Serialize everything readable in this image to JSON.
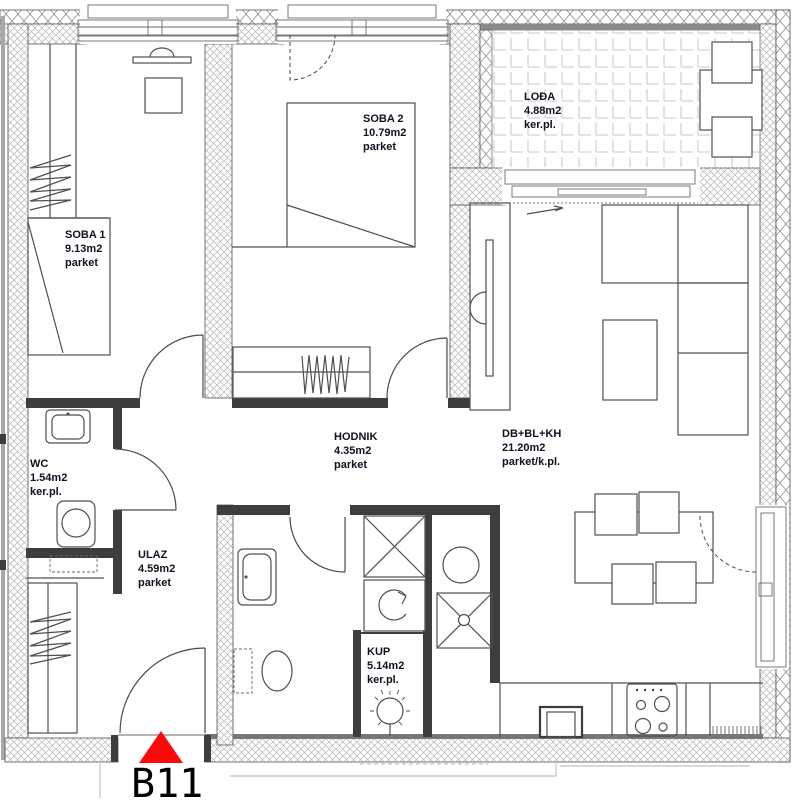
{
  "marker": {
    "label": "B11",
    "color": "#fa0a0a"
  },
  "rooms": [
    {
      "id": "soba1",
      "name": "SOBA 1",
      "area": "9.13m2",
      "floor": "parket"
    },
    {
      "id": "soba2",
      "name": "SOBA 2",
      "area": "10.79m2",
      "floor": "parket"
    },
    {
      "id": "lodja",
      "name": "LOĐA",
      "area": "4.88m2",
      "floor": "ker.pl."
    },
    {
      "id": "dnevni",
      "name": "DB+BL+KH",
      "area": "21.20m2",
      "floor": "parket/k.pl."
    },
    {
      "id": "wc",
      "name": "WC",
      "area": "1.54m2",
      "floor": "ker.pl."
    },
    {
      "id": "ulaz",
      "name": "ULAZ",
      "area": "4.59m2",
      "floor": "parket"
    },
    {
      "id": "hodnik",
      "name": "HODNIK",
      "area": "4.35m2",
      "floor": "parket"
    },
    {
      "id": "kup",
      "name": "KUP",
      "area": "5.14m2",
      "floor": "ker.pl."
    }
  ]
}
